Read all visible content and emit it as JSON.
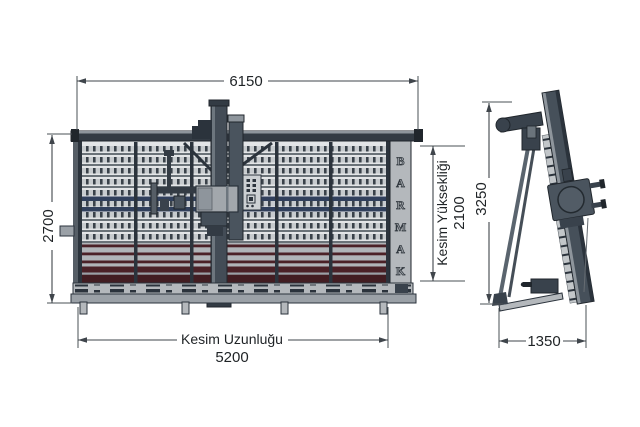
{
  "diagram": {
    "type": "technical-drawing",
    "subject": "Vertical panel saw - front and side elevation with dimensions",
    "brand": "BARMAK",
    "brand_letters": [
      "B",
      "A",
      "R",
      "M",
      "A",
      "K"
    ],
    "front_view": {
      "overall_width_mm": "6150",
      "overall_height_mm": "2700",
      "cutting_length_label": "Kesim Uzunluğu",
      "cutting_length_mm": "5200",
      "cutting_height_label": "Kesim Yüksekliği",
      "cutting_height_mm": "2100"
    },
    "side_view": {
      "overall_height_mm": "3250",
      "depth_mm": "1350"
    },
    "colors": {
      "background": "#ffffff",
      "frame_dark": "#2b333c",
      "slate": "#46505a",
      "panel_gray": "#b4b8bc",
      "slat_light": "#c7cbce",
      "slat_navy": "#31405c",
      "slat_maroon": "#4b2127",
      "dimension_line": "#3f454b"
    }
  }
}
